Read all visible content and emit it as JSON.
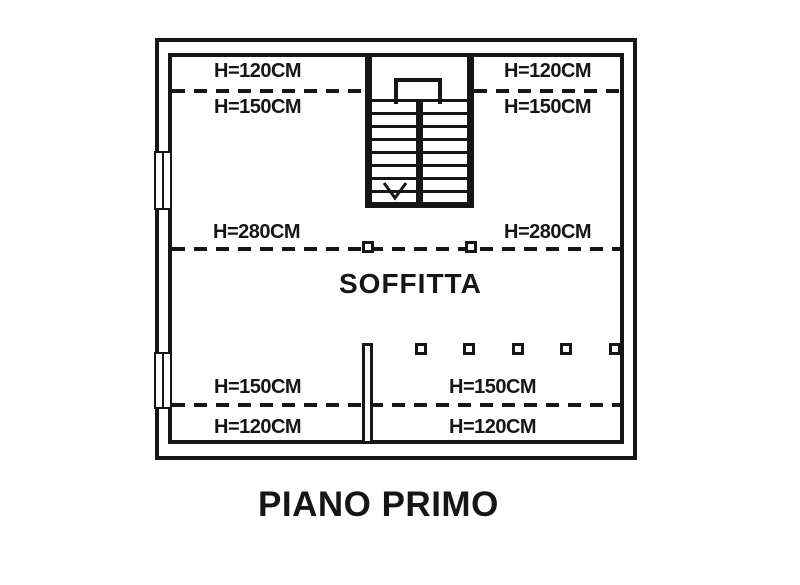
{
  "plan": {
    "room_label": "SOFFITTA",
    "height_labels": {
      "top_left_upper": "H=120CM",
      "top_left_lower": "H=150CM",
      "top_right_upper": "H=120CM",
      "top_right_lower": "H=150CM",
      "middle_left": "H=280CM",
      "middle_right": "H=280CM",
      "bottom_left_upper": "H=150CM",
      "bottom_left_lower": "H=120CM",
      "bottom_right_upper": "H=150CM",
      "bottom_right_lower": "H=120CM"
    },
    "stair_direction": "down",
    "colors": {
      "line": "#161616",
      "background": "#ffffff"
    }
  },
  "page": {
    "title": "PIANO PRIMO"
  }
}
